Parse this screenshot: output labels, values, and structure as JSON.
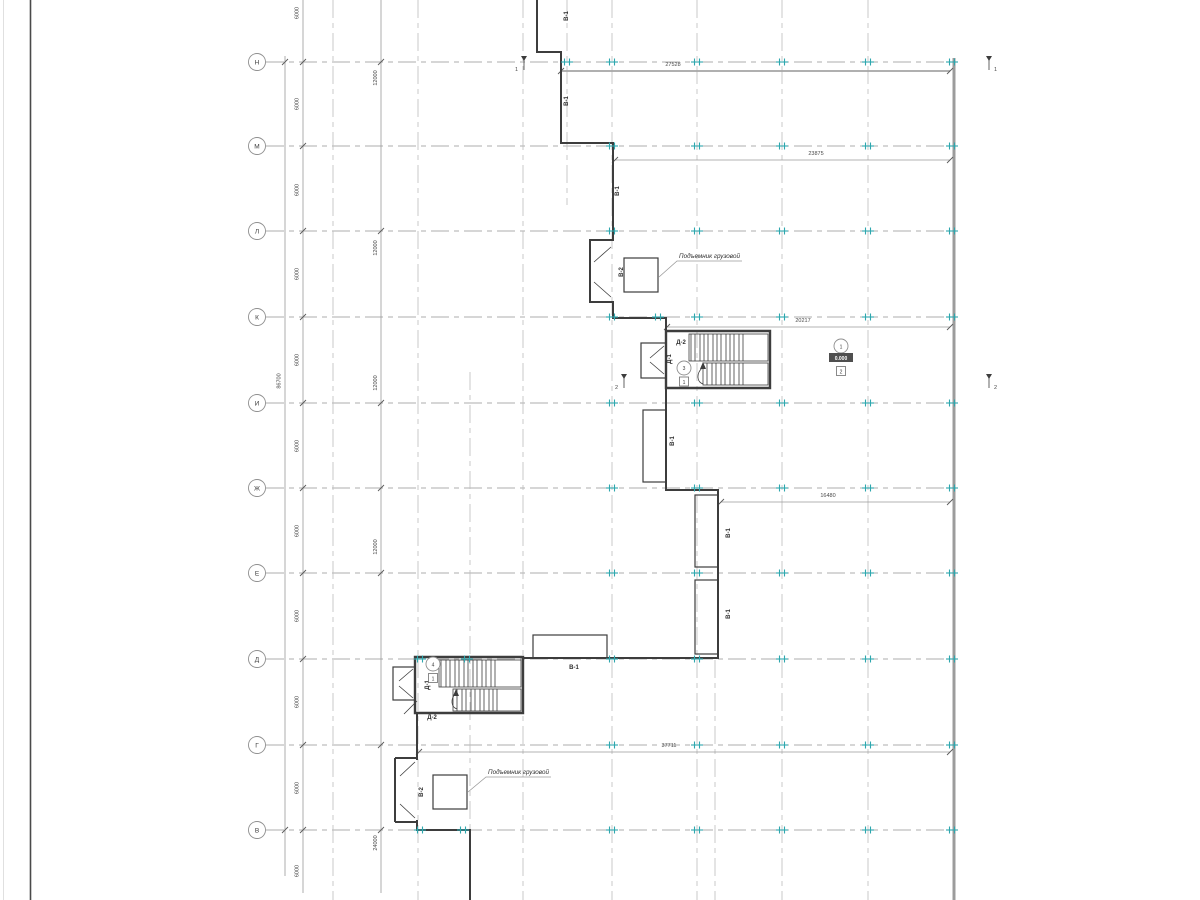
{
  "meta": {
    "type": "cad-floor-plan-view"
  },
  "colors": {
    "wall": "#3d3d3d",
    "grid": "#aeaeae",
    "dimension": "#9a9a9a",
    "grid_tick": "#2ea7ae",
    "muted_wall": "#9c9c9c",
    "text": "#3c3c3c"
  },
  "axes": {
    "rows": [
      "Н",
      "М",
      "Л",
      "К",
      "И",
      "Ж",
      "Е",
      "Д",
      "Г",
      "В"
    ]
  },
  "dims": {
    "bay": "6000",
    "double_bay": "12000",
    "quad_bay": "24000",
    "overall": "86700",
    "horizontal": [
      "27528",
      "23875",
      "20217",
      "16480",
      "37711"
    ]
  },
  "labels": {
    "window": "В-1",
    "hoist_door": "В-2",
    "door1": "Д-1",
    "door2": "Д-2",
    "hoist": "Подъемник грузовой"
  },
  "sections": {
    "one": "1",
    "two": "2"
  },
  "markers": {
    "mid_stair": {
      "circle": "3",
      "box": "1"
    },
    "site": {
      "circle": "1",
      "elevation": "0.000",
      "box": "2"
    },
    "bottom_stair": {
      "circle": "4",
      "box": "1"
    }
  }
}
